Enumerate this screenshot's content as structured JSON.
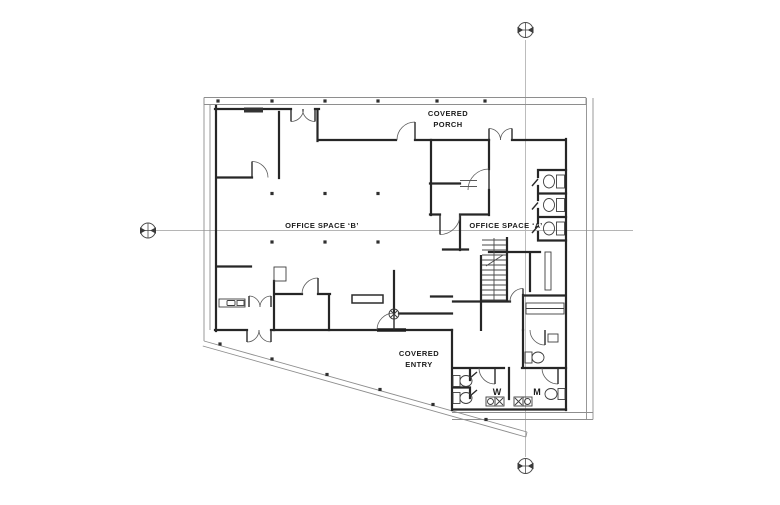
{
  "drawing": {
    "type": "architectural floor plan",
    "labels": {
      "porch_line1": "COVERED",
      "porch_line2": "PORCH",
      "office_b": "OFFICE SPACE ‘B’",
      "office_a": "OFFICE SPACE ‘A’",
      "entry_line1": "COVERED",
      "entry_line2": "ENTRY",
      "restroom_w": "W",
      "restroom_m": "M"
    },
    "markers": [
      {
        "name": "datum-marker-top",
        "x": 525,
        "y": 30
      },
      {
        "name": "datum-marker-left",
        "x": 148,
        "y": 230
      },
      {
        "name": "datum-marker-bottom",
        "x": 525,
        "y": 466
      }
    ],
    "colors": {
      "background": "#ffffff",
      "wall": "#262626",
      "thin_line": "#5a5a5a",
      "canopy_line": "#8e8e8e",
      "reference_line": "#b5b5b5",
      "text": "#1c1c1c"
    }
  }
}
